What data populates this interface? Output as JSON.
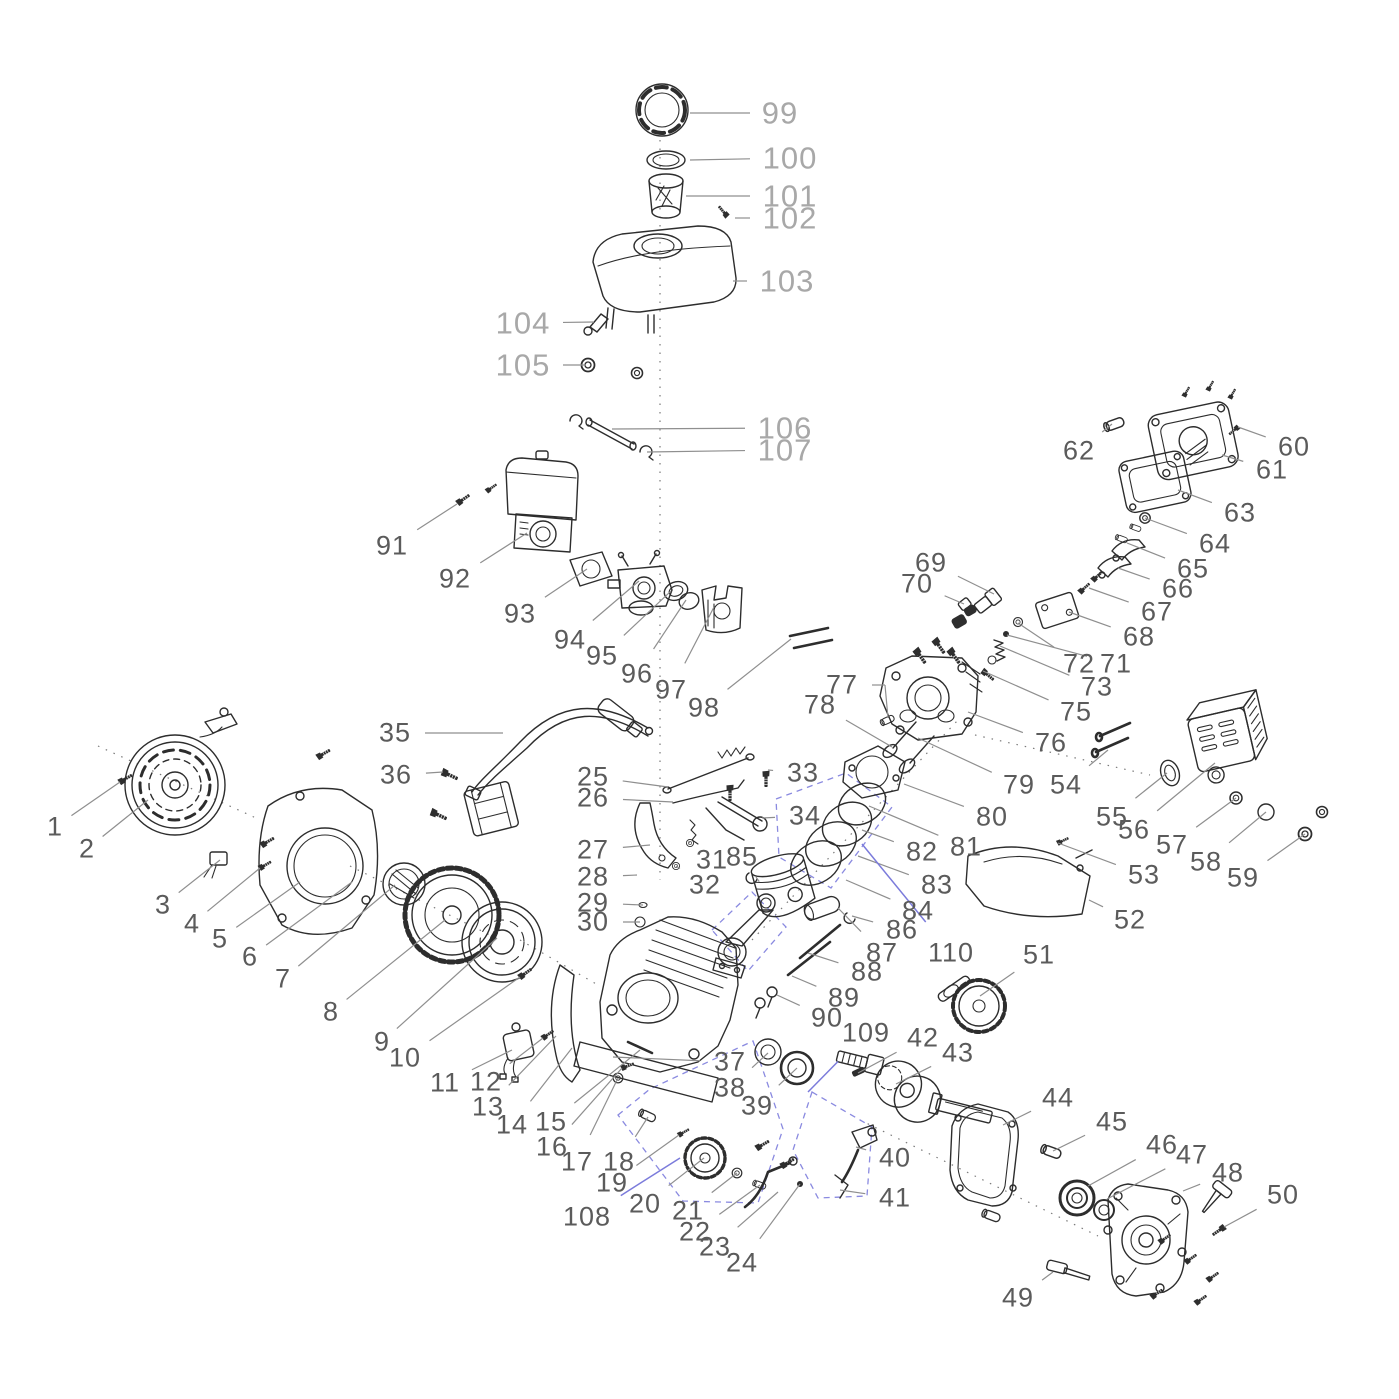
{
  "diagram": {
    "figure": "small gasoline engine exploded parts view",
    "colors": {
      "label_dark": "#5b5b5b",
      "label_light": "#a8a8a8",
      "leader_gray": "#8f8f8f",
      "highlight_blue": "#7b7bdb",
      "line_ink": "#2d2d2d"
    },
    "labels": [
      {
        "n": "1",
        "x": 55,
        "y": 827,
        "tx": 120,
        "ty": 782
      },
      {
        "n": "2",
        "x": 87,
        "y": 849,
        "tx": 148,
        "ty": 800
      },
      {
        "n": "3",
        "x": 163,
        "y": 905,
        "tx": 220,
        "ty": 860
      },
      {
        "n": "4",
        "x": 192,
        "y": 924,
        "tx": 260,
        "ty": 868
      },
      {
        "n": "5",
        "x": 220,
        "y": 939,
        "tx": 300,
        "ty": 882
      },
      {
        "n": "6",
        "x": 250,
        "y": 957,
        "tx": 352,
        "ty": 882
      },
      {
        "n": "7",
        "x": 283,
        "y": 979,
        "tx": 395,
        "ty": 885
      },
      {
        "n": "8",
        "x": 331,
        "y": 1012,
        "tx": 445,
        "ty": 920
      },
      {
        "n": "9",
        "x": 382,
        "y": 1042,
        "tx": 497,
        "ty": 938
      },
      {
        "n": "10",
        "x": 405,
        "y": 1058,
        "tx": 520,
        "ty": 977
      },
      {
        "n": "11",
        "x": 445,
        "y": 1083,
        "tx": 512,
        "ty": 1050
      },
      {
        "n": "12",
        "x": 486,
        "y": 1082,
        "tx": 543,
        "ty": 1038
      },
      {
        "n": "13",
        "x": 488,
        "y": 1107,
        "tx": 556,
        "ty": 1036
      },
      {
        "n": "14",
        "x": 512,
        "y": 1125,
        "tx": 572,
        "ty": 1048
      },
      {
        "n": "15",
        "x": 551,
        "y": 1122,
        "tx": 640,
        "ty": 1050
      },
      {
        "n": "16",
        "x": 552,
        "y": 1147,
        "tx": 622,
        "ty": 1068
      },
      {
        "n": "17",
        "x": 577,
        "y": 1162,
        "tx": 618,
        "ty": 1078
      },
      {
        "n": "18",
        "x": 619,
        "y": 1162,
        "tx": 648,
        "ty": 1117
      },
      {
        "n": "19",
        "x": 612,
        "y": 1183,
        "tx": 679,
        "ty": 1135
      },
      {
        "n": "20",
        "x": 645,
        "y": 1204,
        "tx": 704,
        "ty": 1158
      },
      {
        "n": "21",
        "x": 688,
        "y": 1211,
        "tx": 737,
        "ty": 1173
      },
      {
        "n": "22",
        "x": 695,
        "y": 1232,
        "tx": 760,
        "ty": 1185
      },
      {
        "n": "23",
        "x": 715,
        "y": 1247,
        "tx": 778,
        "ty": 1192
      },
      {
        "n": "24",
        "x": 742,
        "y": 1263,
        "tx": 800,
        "ty": 1184
      },
      {
        "n": "25",
        "x": 593,
        "y": 777,
        "tx": 668,
        "ty": 787
      },
      {
        "n": "26",
        "x": 593,
        "y": 798,
        "tx": 673,
        "ty": 802
      },
      {
        "n": "27",
        "x": 593,
        "y": 850,
        "tx": 650,
        "ty": 845
      },
      {
        "n": "28",
        "x": 593,
        "y": 877,
        "tx": 637,
        "ty": 875
      },
      {
        "n": "29",
        "x": 593,
        "y": 903,
        "tx": 643,
        "ty": 905
      },
      {
        "n": "30",
        "x": 593,
        "y": 922,
        "tx": 640,
        "ty": 922
      },
      {
        "n": "31",
        "x": 712,
        "y": 860,
        "tx": 690,
        "ty": 843
      },
      {
        "n": "32",
        "x": 705,
        "y": 885,
        "tx": 676,
        "ty": 866
      },
      {
        "n": "33",
        "x": 803,
        "y": 773,
        "tx": 768,
        "ty": 770
      },
      {
        "n": "34",
        "x": 805,
        "y": 816,
        "tx": 762,
        "ty": 818
      },
      {
        "n": "35",
        "x": 395,
        "y": 733,
        "tx": 503,
        "ty": 733
      },
      {
        "n": "36",
        "x": 396,
        "y": 775,
        "tx": 443,
        "ty": 772
      },
      {
        "n": "37",
        "x": 730,
        "y": 1062,
        "tx": 613,
        "ty": 1057
      },
      {
        "n": "38",
        "x": 730,
        "y": 1088,
        "tx": 768,
        "ty": 1053
      },
      {
        "n": "39",
        "x": 757,
        "y": 1106,
        "tx": 797,
        "ty": 1068
      },
      {
        "n": "40",
        "x": 895,
        "y": 1158,
        "tx": 856,
        "ty": 1147
      },
      {
        "n": "41",
        "x": 895,
        "y": 1198,
        "tx": 840,
        "ty": 1190
      },
      {
        "n": "42",
        "x": 923,
        "y": 1038,
        "tx": 858,
        "ty": 1073
      },
      {
        "n": "43",
        "x": 958,
        "y": 1053,
        "tx": 896,
        "ty": 1084
      },
      {
        "n": "44",
        "x": 1058,
        "y": 1098,
        "tx": 1003,
        "ty": 1125
      },
      {
        "n": "45",
        "x": 1112,
        "y": 1122,
        "tx": 1053,
        "ty": 1151
      },
      {
        "n": "46",
        "x": 1162,
        "y": 1145,
        "tx": 1088,
        "ty": 1186
      },
      {
        "n": "47",
        "x": 1192,
        "y": 1155,
        "tx": 1107,
        "ty": 1199
      },
      {
        "n": "48",
        "x": 1228,
        "y": 1173,
        "tx": 1183,
        "ty": 1191
      },
      {
        "n": "49",
        "x": 1018,
        "y": 1298,
        "tx": 1053,
        "ty": 1272
      },
      {
        "n": "50",
        "x": 1283,
        "y": 1195,
        "tx": 1224,
        "ty": 1227
      },
      {
        "n": "51",
        "x": 1039,
        "y": 955,
        "tx": 980,
        "ty": 996
      },
      {
        "n": "52",
        "x": 1130,
        "y": 920,
        "tx": 1089,
        "ty": 900
      },
      {
        "n": "53",
        "x": 1144,
        "y": 875,
        "tx": 1058,
        "ty": 843
      },
      {
        "n": "54",
        "x": 1066,
        "y": 785,
        "tx": 1108,
        "ty": 750
      },
      {
        "n": "55",
        "x": 1112,
        "y": 817,
        "tx": 1167,
        "ty": 773
      },
      {
        "n": "56",
        "x": 1134,
        "y": 830,
        "tx": 1215,
        "ty": 763
      },
      {
        "n": "57",
        "x": 1172,
        "y": 845,
        "tx": 1236,
        "ty": 798
      },
      {
        "n": "58",
        "x": 1206,
        "y": 862,
        "tx": 1266,
        "ty": 812
      },
      {
        "n": "59",
        "x": 1243,
        "y": 878,
        "tx": 1305,
        "ty": 834
      },
      {
        "n": "60",
        "x": 1294,
        "y": 447,
        "tx": 1238,
        "ty": 427
      },
      {
        "n": "61",
        "x": 1272,
        "y": 470,
        "tx": 1222,
        "ty": 455
      },
      {
        "n": "62",
        "x": 1079,
        "y": 451,
        "tx": 1112,
        "ty": 424
      },
      {
        "n": "63",
        "x": 1240,
        "y": 513,
        "tx": 1178,
        "ty": 490
      },
      {
        "n": "64",
        "x": 1215,
        "y": 544,
        "tx": 1145,
        "ty": 518
      },
      {
        "n": "65",
        "x": 1193,
        "y": 569,
        "tx": 1127,
        "ty": 543
      },
      {
        "n": "66",
        "x": 1178,
        "y": 589,
        "tx": 1118,
        "ty": 568
      },
      {
        "n": "67",
        "x": 1157,
        "y": 612,
        "tx": 1089,
        "ty": 588
      },
      {
        "n": "68",
        "x": 1139,
        "y": 637,
        "tx": 1069,
        "ty": 612
      },
      {
        "n": "69",
        "x": 931,
        "y": 563,
        "tx": 994,
        "ty": 594
      },
      {
        "n": "70",
        "x": 917,
        "y": 584,
        "tx": 964,
        "ty": 604
      },
      {
        "n": "71",
        "x": 1116,
        "y": 664,
        "tx": 1007,
        "ty": 635
      },
      {
        "n": "72",
        "x": 1079,
        "y": 664,
        "tx": 1018,
        "ty": 623
      },
      {
        "n": "73",
        "x": 1097,
        "y": 687,
        "tx": 1000,
        "ty": 646
      },
      {
        "n": "75",
        "x": 1076,
        "y": 712,
        "tx": 983,
        "ty": 671
      },
      {
        "n": "76",
        "x": 1051,
        "y": 743,
        "tx": 968,
        "ty": 712
      },
      {
        "n": "77",
        "x": 842,
        "y": 685,
        "ex": 885,
        "ey": 685,
        "tx": 888,
        "ty": 718
      },
      {
        "n": "78",
        "x": 820,
        "y": 705,
        "tx": 892,
        "ty": 747
      },
      {
        "n": "79",
        "x": 1019,
        "y": 785,
        "tx": 918,
        "ty": 738
      },
      {
        "n": "80",
        "x": 992,
        "y": 817,
        "tx": 904,
        "ty": 784
      },
      {
        "n": "81",
        "x": 966,
        "y": 847,
        "tx": 869,
        "ty": 806
      },
      {
        "n": "82",
        "x": 922,
        "y": 852,
        "tx": 862,
        "ty": 830
      },
      {
        "n": "83",
        "x": 937,
        "y": 885,
        "tx": 858,
        "ty": 856
      },
      {
        "n": "84",
        "x": 918,
        "y": 911,
        "tx": 846,
        "ty": 880
      },
      {
        "n": "85",
        "x": 742,
        "y": 857,
        "tx": 756,
        "ty": 877
      },
      {
        "n": "86",
        "x": 902,
        "y": 930,
        "tx": 852,
        "ty": 916
      },
      {
        "n": "87",
        "x": 882,
        "y": 953,
        "tx": 838,
        "ty": 908
      },
      {
        "n": "88",
        "x": 867,
        "y": 972,
        "tx": 808,
        "ty": 953
      },
      {
        "n": "89",
        "x": 844,
        "y": 998,
        "tx": 792,
        "ty": 976
      },
      {
        "n": "90",
        "x": 827,
        "y": 1018,
        "tx": 777,
        "ty": 995
      },
      {
        "n": "91",
        "x": 392,
        "y": 546,
        "tx": 457,
        "ty": 504
      },
      {
        "n": "92",
        "x": 455,
        "y": 579,
        "tx": 527,
        "ty": 533
      },
      {
        "n": "93",
        "x": 520,
        "y": 614,
        "tx": 587,
        "ty": 569
      },
      {
        "n": "94",
        "x": 570,
        "y": 640,
        "tx": 639,
        "ty": 581
      },
      {
        "n": "95",
        "x": 602,
        "y": 656,
        "tx": 671,
        "ty": 591
      },
      {
        "n": "96",
        "x": 637,
        "y": 674,
        "tx": 686,
        "ty": 600
      },
      {
        "n": "97",
        "x": 671,
        "y": 690,
        "tx": 714,
        "ty": 607
      },
      {
        "n": "98",
        "x": 704,
        "y": 708,
        "tx": 791,
        "ty": 639
      },
      {
        "n": "99",
        "x": 780,
        "y": 113,
        "tx": 690,
        "ty": 113,
        "style": "light"
      },
      {
        "n": "100",
        "x": 790,
        "y": 158,
        "tx": 690,
        "ty": 160,
        "style": "light"
      },
      {
        "n": "101",
        "x": 790,
        "y": 196,
        "tx": 686,
        "ty": 196,
        "style": "light"
      },
      {
        "n": "102",
        "x": 790,
        "y": 218,
        "tx": 735,
        "ty": 218,
        "style": "light"
      },
      {
        "n": "103",
        "x": 787,
        "y": 281,
        "tx": 733,
        "ty": 281,
        "style": "light"
      },
      {
        "n": "104",
        "x": 523,
        "y": 323,
        "tx": 594,
        "ty": 322,
        "style": "light"
      },
      {
        "n": "105",
        "x": 523,
        "y": 365,
        "tx": 586,
        "ty": 365,
        "style": "light"
      },
      {
        "n": "106",
        "x": 785,
        "y": 428,
        "tx": 612,
        "ty": 429,
        "style": "light"
      },
      {
        "n": "107",
        "x": 785,
        "y": 450,
        "tx": 647,
        "ty": 452,
        "style": "light"
      },
      {
        "n": "108",
        "x": 587,
        "y": 1217,
        "tx": 680,
        "ty": 1158,
        "lc": "blue"
      },
      {
        "n": "109",
        "x": 866,
        "y": 1033,
        "tx": 808,
        "ty": 1092,
        "lc": "blue"
      },
      {
        "n": "110",
        "x": 951,
        "y": 953,
        "tx": 862,
        "ty": 844,
        "lc": "blue"
      }
    ]
  }
}
